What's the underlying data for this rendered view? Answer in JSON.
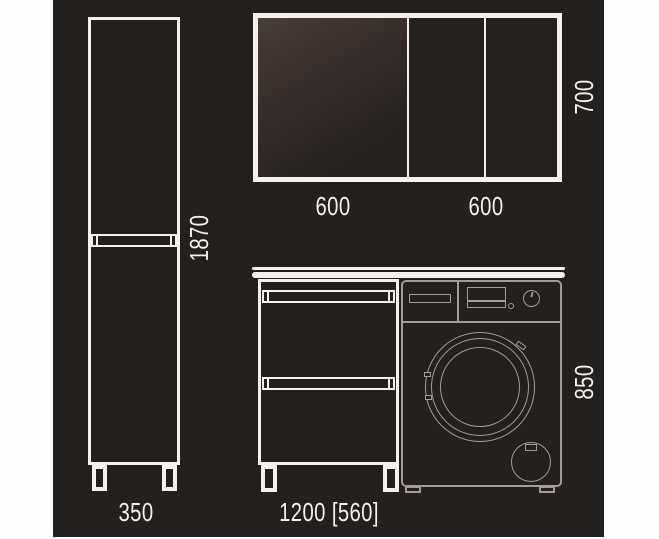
{
  "diagram": {
    "type": "furniture-dimension-drawing",
    "colors": {
      "paper": "#fdfdfd",
      "canvas": "#242020",
      "line": "#f5f1ec",
      "washer_line": "#a59a96"
    },
    "labels": {
      "tall_cabinet_width": "350",
      "tall_cabinet_height": "1870",
      "mirror_left_width": "600",
      "mirror_right_width": "600",
      "mirror_height": "700",
      "vanity_width": "1200 [560]",
      "vanity_height": "850"
    },
    "dimensions_mm": {
      "tall_cabinet": {
        "width": 350,
        "height": 1870
      },
      "mirror_cabinet": {
        "door_left": 600,
        "door_right": 600,
        "height": 700
      },
      "vanity_unit": {
        "total_width": 1200,
        "washer_niche_width": 560,
        "height": 850
      }
    }
  }
}
